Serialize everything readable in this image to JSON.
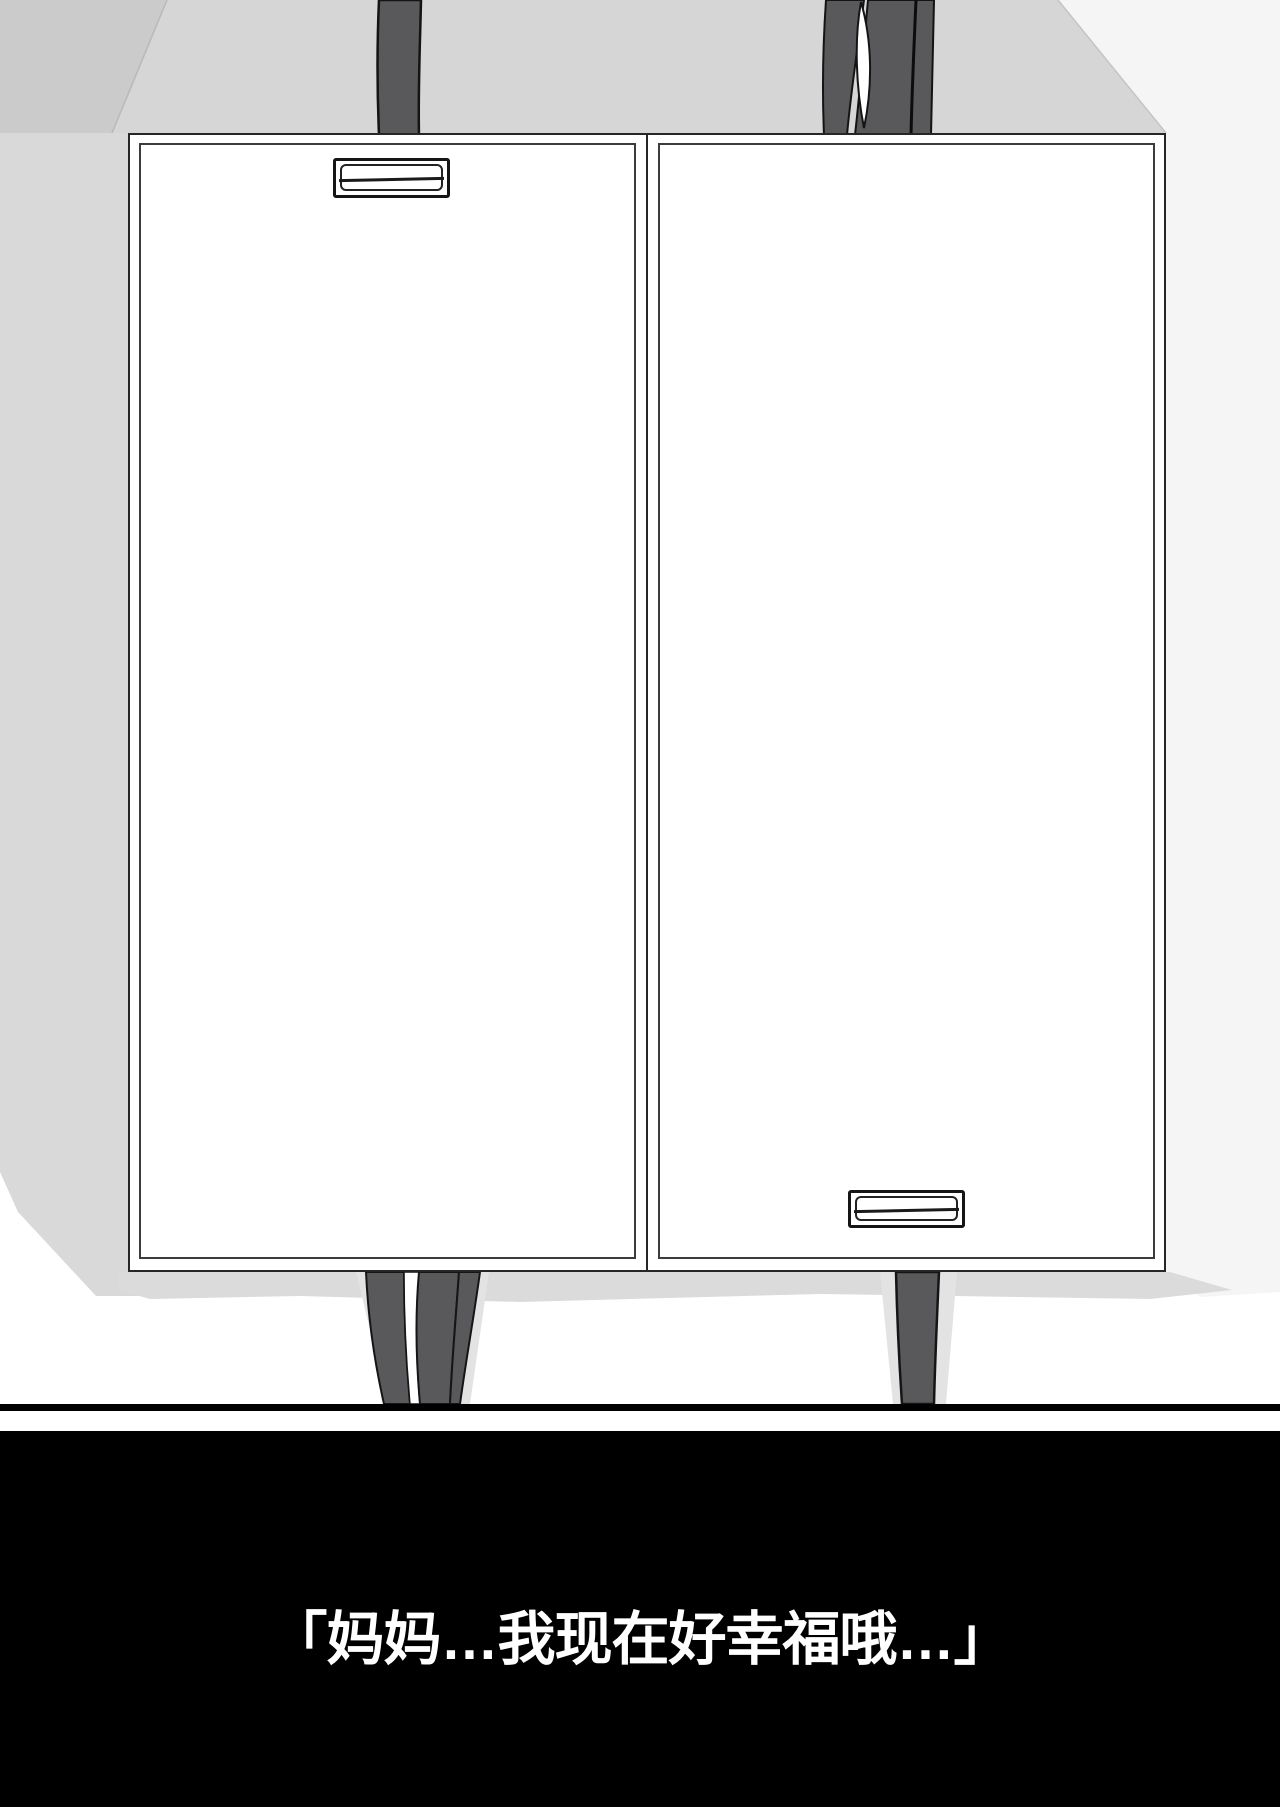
{
  "page": {
    "kind": "manga-page"
  },
  "caption": {
    "text": "「妈妈…我现在好幸福哦…」",
    "color": "#ffffff",
    "background": "#000000"
  },
  "colors": {
    "backdrop_gray": "#d6d6d6",
    "backdrop_shade": "#cbcbcb",
    "backdrop_highlight": "#f5f5f5",
    "wall_left_gray": "#d9d9d9",
    "floor_shadow": "#dbdbdb",
    "strap_halo": "#e3e3e3",
    "strap_fill": "#59595b",
    "line_ink": "#141414",
    "cabinet_face": "#ffffff",
    "cabinet_border": "#262626",
    "frame_line": "#000000"
  }
}
